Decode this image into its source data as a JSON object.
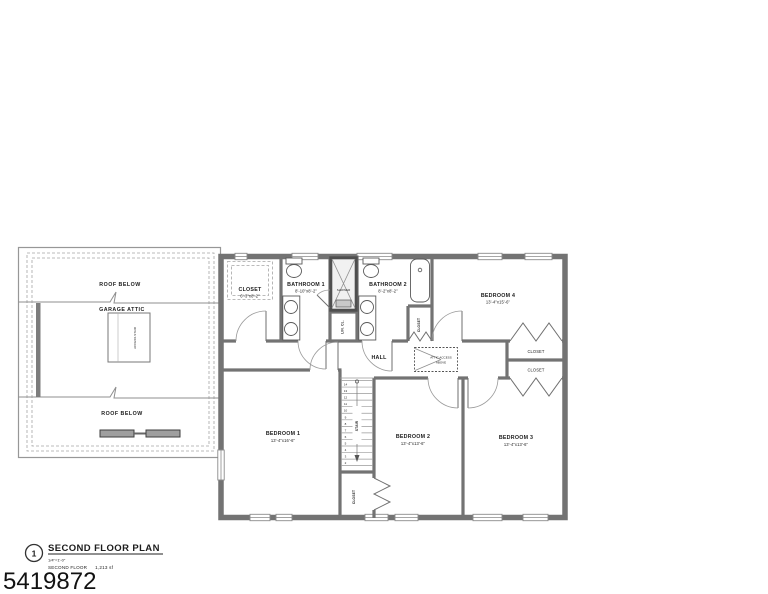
{
  "photo_id": "5419872",
  "title_block": {
    "detail_number": "1",
    "title": "SECOND FLOOR PLAN",
    "scale": "1/4\"=1'-0\"",
    "floor_label": "SECOND FLOOR",
    "area": "1,213 sf"
  },
  "left_wing": {
    "roof_below_top": "ROOF BELOW",
    "garage_attic": "GARAGE ATTIC",
    "access_stair": "ACCESS STAIR",
    "roof_below_bottom": "ROOF BELOW"
  },
  "rooms": {
    "closet_main": {
      "name": "CLOSET",
      "dims": "6'-3\"x8'-2\""
    },
    "bathroom_1": {
      "name": "BATHROOM 1",
      "dims": "8'-10\"x8'-2\""
    },
    "shower": {
      "name": "SHOWER"
    },
    "linen_closet": {
      "name": "LIN. CL."
    },
    "bathroom_2": {
      "name": "BATHROOM 2",
      "dims": "8'-2\"x8'-2\""
    },
    "bathroom_2_closet": {
      "name": "CLOSET"
    },
    "bedroom_4": {
      "name": "BEDROOM 4",
      "dims": "13'-4\"x15'-6\""
    },
    "bedroom_4_closet": {
      "name": "CLOSET"
    },
    "bedroom_3_closet": {
      "name": "CLOSET"
    },
    "hall": {
      "name": "HALL"
    },
    "attic_access_line1": "ATTIC ACCESS",
    "attic_access_line2": "ABOVE",
    "stair": {
      "name": "STAIR"
    },
    "bedroom_2_closet": {
      "name": "CLOSET"
    },
    "bedroom_1": {
      "name": "BEDROOM 1",
      "dims": "13'-4\"x16'-6\""
    },
    "bedroom_2": {
      "name": "BEDROOM 2",
      "dims": "13'-4\"x13'-6\""
    },
    "bedroom_3": {
      "name": "BEDROOM 3",
      "dims": "13'-4\"x13'-6\""
    }
  },
  "stair_treads": [
    "14",
    "13",
    "12",
    "11",
    "10",
    "9",
    "8",
    "7",
    "6",
    "5",
    "4",
    "3",
    "2"
  ]
}
